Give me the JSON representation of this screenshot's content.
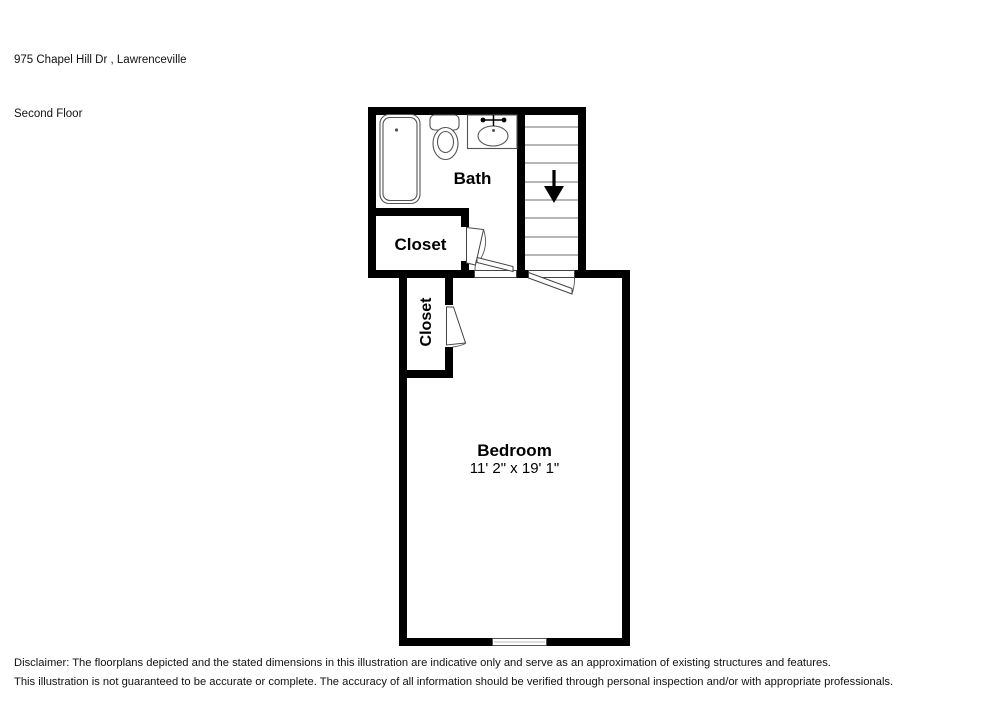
{
  "header": {
    "address": "975 Chapel Hill Dr , Lawrenceville",
    "floor": "Second Floor"
  },
  "rooms": {
    "bath": {
      "label": "Bath"
    },
    "closet_upper": {
      "label": "Closet"
    },
    "closet_lower": {
      "label": "Closet"
    },
    "bedroom": {
      "label": "Bedroom",
      "dimensions": "11' 2\" x 19' 1\""
    }
  },
  "stairs": {
    "direction": "down",
    "tread_count": 8
  },
  "colors": {
    "wall": "#000000",
    "fixture_outline": "#555555",
    "door_outline": "#444444",
    "tread_line": "#8a8a8a",
    "background": "#ffffff"
  },
  "disclaimer": {
    "line1": "Disclaimer: The floorplans depicted and the stated dimensions in this illustration are indicative only and serve as an approximation of existing structures and features.",
    "line2": "This illustration is not guaranteed to be accurate or complete. The accuracy of all information should be verified through personal inspection and/or with appropriate professionals."
  }
}
